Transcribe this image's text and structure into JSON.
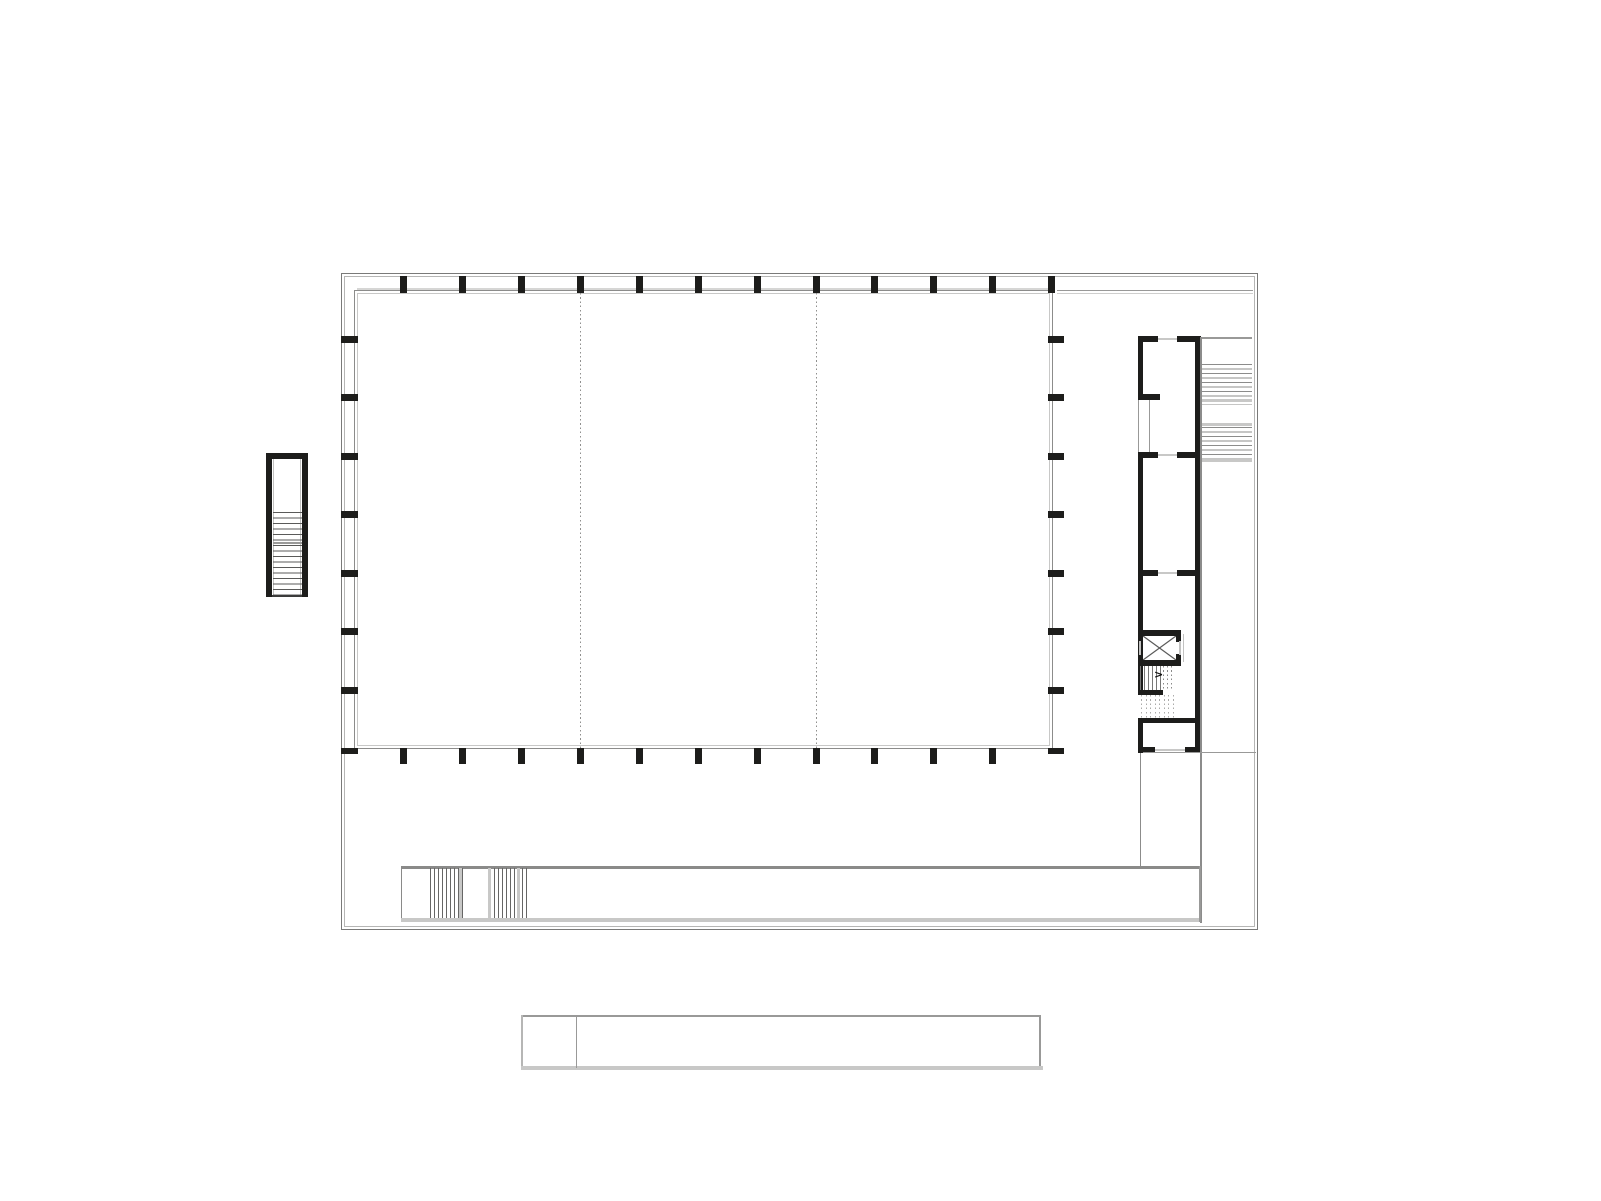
{
  "document": {
    "kind": "architectural-floor-plan",
    "description": "black and white line drawing of a building floor plan: large column-framed hall with three bays, service annex with elevator and stairs on the right, external stair on the left, entry ramp walkway at the bottom, and a detached plan strip below"
  },
  "palette": {
    "wall": "#1d1d1b",
    "line_dark": "#6f6f6e",
    "line_mid": "#999998",
    "line_light": "#c8c8c7",
    "canvas": "#ffffff"
  },
  "canvas": {
    "width": 1601,
    "height": 1201
  },
  "elements": [
    {
      "type": "outline",
      "name": "site-boundary-outer",
      "x": 341,
      "y": 273,
      "w": 917,
      "h": 657,
      "color": "#7a7a79"
    },
    {
      "type": "outline",
      "name": "site-boundary-inner",
      "x": 344,
      "y": 276,
      "w": 911,
      "h": 651,
      "color": "#b6b6b5"
    },
    {
      "type": "bar",
      "name": "canopy-edge-top-line",
      "x": 357,
      "y": 288,
      "w": 696,
      "h": 2,
      "color": "#d6d6d5"
    },
    {
      "type": "outline",
      "name": "hall-outline",
      "x": 354,
      "y": 290,
      "w": 699,
      "h": 459,
      "color": "#8c8c8b"
    },
    {
      "type": "outline",
      "name": "hall-inner-face-line",
      "x": 357,
      "y": 293,
      "w": 693,
      "h": 453,
      "color": "#c8c8c7"
    },
    {
      "type": "vdotted",
      "name": "hall-bay-divider-line-1",
      "x": 580,
      "h": 455,
      "y": 293,
      "color": "#8f8f8e"
    },
    {
      "type": "vdotted",
      "name": "hall-bay-divider-line-2",
      "x": 816,
      "h": 455,
      "y": 293,
      "color": "#8f8f8e"
    },
    {
      "type": "bar",
      "name": "hall-top-line-extension",
      "x": 1057,
      "y": 290,
      "w": 196,
      "h": 1,
      "color": "#999998"
    },
    {
      "type": "bar",
      "name": "hall-top-line-extension-light",
      "x": 1057,
      "y": 293,
      "w": 196,
      "h": 1,
      "color": "#cfcfce"
    },
    {
      "type": "repeat",
      "name": "hall-columns-top",
      "xs": [
        400,
        459,
        518,
        577,
        636,
        695,
        754,
        813,
        871,
        930,
        989,
        1048
      ],
      "y": 276,
      "w": 7,
      "h": 17,
      "color": "#1d1d1b"
    },
    {
      "type": "repeat",
      "name": "hall-columns-bottom",
      "xs": [
        400,
        459,
        518,
        577,
        636,
        695,
        754,
        813,
        871,
        930,
        989
      ],
      "y": 748,
      "w": 7,
      "h": 16,
      "color": "#1d1d1b"
    },
    {
      "type": "repeat",
      "name": "hall-columns-left",
      "ys": [
        336,
        394,
        453,
        511,
        570,
        628,
        687
      ],
      "x": 341,
      "w": 17,
      "h": 7,
      "color": "#1d1d1b"
    },
    {
      "type": "repeat",
      "name": "hall-columns-right",
      "ys": [
        336,
        394,
        453,
        511,
        570,
        628,
        687
      ],
      "x": 1048,
      "w": 16,
      "h": 7,
      "color": "#1d1d1b"
    },
    {
      "type": "bar",
      "name": "hall-corner-column-bottom-left",
      "x": 341,
      "y": 748,
      "w": 17,
      "h": 6,
      "color": "#1d1d1b"
    },
    {
      "type": "bar",
      "name": "hall-corner-column-bottom-right",
      "x": 1048,
      "y": 748,
      "w": 16,
      "h": 6,
      "color": "#1d1d1b"
    },
    {
      "type": "bar",
      "name": "left-stair-wall-left",
      "x": 266,
      "y": 453,
      "w": 6,
      "h": 144,
      "color": "#1d1d1b"
    },
    {
      "type": "bar",
      "name": "left-stair-wall-top",
      "x": 266,
      "y": 453,
      "w": 42,
      "h": 6,
      "color": "#1d1d1b"
    },
    {
      "type": "bar",
      "name": "left-stair-wall-right",
      "x": 302,
      "y": 453,
      "w": 6,
      "h": 144,
      "color": "#1d1d1b"
    },
    {
      "type": "bar",
      "name": "left-stair-bottom-line",
      "x": 272,
      "y": 595,
      "w": 30,
      "h": 2,
      "color": "#3c3c3b"
    },
    {
      "type": "bar",
      "name": "left-stair-inner-face-left",
      "x": 273,
      "y": 459,
      "w": 1,
      "h": 136,
      "color": "#c2c2c1"
    },
    {
      "type": "bar",
      "name": "left-stair-inner-face-right",
      "x": 300,
      "y": 459,
      "w": 1,
      "h": 136,
      "color": "#c2c2c1"
    },
    {
      "type": "hlines",
      "name": "left-stair-treads",
      "x": 273,
      "y": 512,
      "w": 29,
      "count": 15,
      "gap": 5.5,
      "color": "#5a5a59"
    },
    {
      "type": "bar",
      "name": "left-stair-landing-line",
      "x": 273,
      "y": 542,
      "w": 29,
      "h": 2,
      "color": "#9a9a99"
    },
    {
      "type": "bar",
      "name": "annex-wall-left-upper",
      "x": 1138,
      "y": 336,
      "w": 5,
      "h": 64,
      "color": "#1d1d1b"
    },
    {
      "type": "bar",
      "name": "annex-glazing-line-outer",
      "x": 1138,
      "y": 400,
      "w": 1,
      "h": 53,
      "color": "#999998"
    },
    {
      "type": "bar",
      "name": "annex-glazing-line-inner",
      "x": 1149,
      "y": 400,
      "w": 1,
      "h": 53,
      "color": "#999998"
    },
    {
      "type": "bar",
      "name": "annex-wall-left-mid",
      "x": 1138,
      "y": 453,
      "w": 5,
      "h": 242,
      "color": "#1d1d1b"
    },
    {
      "type": "bar",
      "name": "annex-wall-left-lower",
      "x": 1138,
      "y": 718,
      "w": 5,
      "h": 35,
      "color": "#1d1d1b"
    },
    {
      "type": "bar",
      "name": "annex-wall-right",
      "x": 1195,
      "y": 336,
      "w": 6,
      "h": 417,
      "color": "#1d1d1b"
    },
    {
      "type": "bar",
      "name": "annex-wall-top-a",
      "x": 1138,
      "y": 336,
      "w": 20,
      "h": 6,
      "color": "#1d1d1b"
    },
    {
      "type": "bar",
      "name": "annex-wall-top-b",
      "x": 1177,
      "y": 336,
      "w": 24,
      "h": 6,
      "color": "#1d1d1b"
    },
    {
      "type": "bar",
      "name": "annex-door-top",
      "x": 1158,
      "y": 338,
      "w": 19,
      "h": 2,
      "color": "#c8c8c7"
    },
    {
      "type": "bar",
      "name": "annex-wall-bottom-a",
      "x": 1138,
      "y": 747,
      "w": 17,
      "h": 6,
      "color": "#1d1d1b"
    },
    {
      "type": "bar",
      "name": "annex-wall-bottom-b",
      "x": 1185,
      "y": 747,
      "w": 16,
      "h": 6,
      "color": "#1d1d1b"
    },
    {
      "type": "bar",
      "name": "annex-door-bottom",
      "x": 1155,
      "y": 749,
      "w": 30,
      "h": 2,
      "color": "#c8c8c7"
    },
    {
      "type": "bar",
      "name": "annex-partition-wall-a",
      "x": 1138,
      "y": 394,
      "w": 22,
      "h": 6,
      "color": "#1d1d1b"
    },
    {
      "type": "bar",
      "name": "annex-partition-wall-b1",
      "x": 1138,
      "y": 452,
      "w": 20,
      "h": 6,
      "color": "#1d1d1b"
    },
    {
      "type": "bar",
      "name": "annex-partition-wall-b2",
      "x": 1177,
      "y": 452,
      "w": 24,
      "h": 6,
      "color": "#1d1d1b"
    },
    {
      "type": "bar",
      "name": "annex-door-b",
      "x": 1158,
      "y": 454,
      "w": 19,
      "h": 2,
      "color": "#c8c8c7"
    },
    {
      "type": "bar",
      "name": "annex-partition-wall-c1",
      "x": 1138,
      "y": 570,
      "w": 20,
      "h": 6,
      "color": "#1d1d1b"
    },
    {
      "type": "bar",
      "name": "annex-partition-wall-c2",
      "x": 1177,
      "y": 570,
      "w": 24,
      "h": 6,
      "color": "#1d1d1b"
    },
    {
      "type": "bar",
      "name": "annex-door-c",
      "x": 1158,
      "y": 572,
      "w": 19,
      "h": 2,
      "color": "#c8c8c7"
    },
    {
      "type": "bar",
      "name": "elevator-wall-top",
      "x": 1138,
      "y": 630,
      "w": 43,
      "h": 6,
      "color": "#1d1d1b"
    },
    {
      "type": "bar",
      "name": "elevator-wall-bottom",
      "x": 1138,
      "y": 660,
      "w": 43,
      "h": 6,
      "color": "#1d1d1b"
    },
    {
      "type": "bar",
      "name": "elevator-wall-left-a",
      "x": 1138,
      "y": 630,
      "w": 5,
      "h": 12,
      "color": "#1d1d1b"
    },
    {
      "type": "bar",
      "name": "elevator-wall-left-b",
      "x": 1138,
      "y": 654,
      "w": 5,
      "h": 12,
      "color": "#1d1d1b"
    },
    {
      "type": "bar",
      "name": "elevator-door-left",
      "x": 1139,
      "y": 641,
      "w": 2,
      "h": 14,
      "color": "#c2c2c1"
    },
    {
      "type": "bar",
      "name": "elevator-wall-right-a",
      "x": 1176,
      "y": 630,
      "w": 5,
      "h": 12,
      "color": "#1d1d1b"
    },
    {
      "type": "bar",
      "name": "elevator-wall-right-b",
      "x": 1176,
      "y": 654,
      "w": 5,
      "h": 12,
      "color": "#1d1d1b"
    },
    {
      "type": "bar",
      "name": "elevator-door-right",
      "x": 1179,
      "y": 641,
      "w": 2,
      "h": 14,
      "color": "#c2c2c1"
    },
    {
      "type": "cross",
      "name": "elevator-cross-symbol",
      "x": 1143,
      "y": 636,
      "w": 33,
      "h": 24,
      "color": "#5a5a59"
    },
    {
      "type": "bar",
      "name": "elevator-shaft-side-line",
      "x": 1183,
      "y": 634,
      "w": 1,
      "h": 28,
      "color": "#c2c2c1"
    },
    {
      "type": "vlines",
      "name": "annex-stair-treads-solid",
      "x": 1140,
      "y": 666,
      "h": 24,
      "count": 6,
      "gap": 4,
      "color": "#787877"
    },
    {
      "type": "vdotted",
      "name": "annex-stair-treads-dashed-upper",
      "x": 1163,
      "xs": [
        1163,
        1167,
        1171
      ],
      "y": 666,
      "h": 24,
      "color": "#8a8a89"
    },
    {
      "type": "glyph",
      "name": "annex-stair-direction-arrow",
      "x": 1154,
      "y": 669,
      "text": ">",
      "size": 11,
      "color": "#111111"
    },
    {
      "type": "bar",
      "name": "annex-stair-mid-wall",
      "x": 1138,
      "y": 690,
      "w": 25,
      "h": 5,
      "color": "#1d1d1b"
    },
    {
      "type": "vdotted",
      "name": "annex-stair-treads-dashed-lower",
      "x": 1141,
      "xs": [
        1141,
        1145.5,
        1150,
        1154.5,
        1159,
        1163.5,
        1168,
        1172.5
      ],
      "y": 695,
      "h": 23,
      "color": "#ababaa"
    },
    {
      "type": "bar",
      "name": "annex-stair-bottom-wall",
      "x": 1138,
      "y": 718,
      "w": 63,
      "h": 5,
      "color": "#1d1d1b"
    },
    {
      "type": "bar",
      "name": "right-stair-top-line",
      "x": 1201,
      "y": 337,
      "w": 51,
      "h": 2,
      "color": "#999998"
    },
    {
      "type": "hlines",
      "name": "right-stair-treads-upper",
      "x": 1201,
      "y": 364,
      "w": 51,
      "count": 9,
      "gap": 4.5,
      "color": "#8c8c8b"
    },
    {
      "type": "bar",
      "name": "right-stair-landing-line-1",
      "x": 1201,
      "y": 399,
      "w": 51,
      "h": 3,
      "color": "#c8c8c7"
    },
    {
      "type": "bar",
      "name": "right-stair-landing-line-2",
      "x": 1201,
      "y": 423,
      "w": 51,
      "h": 3,
      "color": "#c8c8c7"
    },
    {
      "type": "hlines",
      "name": "right-stair-treads-lower",
      "x": 1201,
      "y": 427,
      "w": 51,
      "count": 8,
      "gap": 4.5,
      "color": "#8c8c8b"
    },
    {
      "type": "bar",
      "name": "right-stair-landing-line-3",
      "x": 1201,
      "y": 459,
      "w": 51,
      "h": 3,
      "color": "#c8c8c7"
    },
    {
      "type": "bar",
      "name": "right-gallery-edge-line",
      "x": 1200,
      "y": 337,
      "w": 2,
      "h": 586,
      "color": "#8c8c8b"
    },
    {
      "type": "bar",
      "name": "annex-walkway-connector-vline",
      "x": 1140,
      "y": 753,
      "w": 1,
      "h": 114,
      "color": "#8c8c8b"
    },
    {
      "type": "bar",
      "name": "annex-walkway-connector-hline",
      "x": 1143,
      "y": 752,
      "w": 113,
      "h": 1,
      "color": "#999998"
    },
    {
      "type": "bar",
      "name": "walkway-top-edge",
      "x": 401,
      "y": 866,
      "w": 799,
      "h": 3,
      "color": "#8a8a89"
    },
    {
      "type": "bar",
      "name": "walkway-left-edge",
      "x": 401,
      "y": 866,
      "w": 1,
      "h": 56,
      "color": "#8a8a89"
    },
    {
      "type": "bar",
      "name": "walkway-bottom-edge",
      "x": 401,
      "y": 918,
      "w": 800,
      "h": 4,
      "color": "#c8c8c7"
    },
    {
      "type": "bar",
      "name": "walkway-right-edge",
      "x": 1199,
      "y": 866,
      "w": 2,
      "h": 56,
      "color": "#999998"
    },
    {
      "type": "vlines",
      "name": "ramp-hatch-group-a",
      "x": 430,
      "y": 868,
      "h": 50,
      "count": 9,
      "gap": 4,
      "color": "#666665"
    },
    {
      "type": "bar",
      "name": "ramp-hatch-a-light-band",
      "x": 459,
      "y": 868,
      "w": 3,
      "h": 50,
      "color": "#c8c8c7"
    },
    {
      "type": "bar",
      "name": "ramp-hatch-b-light-band-1",
      "x": 488,
      "y": 868,
      "w": 3,
      "h": 50,
      "color": "#c8c8c7"
    },
    {
      "type": "vlines",
      "name": "ramp-hatch-group-b",
      "x": 494,
      "y": 868,
      "h": 50,
      "count": 6,
      "gap": 4,
      "color": "#666665"
    },
    {
      "type": "bar",
      "name": "ramp-hatch-b-light-band-2",
      "x": 517,
      "y": 868,
      "w": 3,
      "h": 50,
      "color": "#c8c8c7"
    },
    {
      "type": "vlines",
      "name": "ramp-hatch-group-b-tail",
      "x": 522,
      "y": 868,
      "h": 50,
      "count": 2,
      "gap": 4,
      "color": "#666665"
    },
    {
      "type": "bar",
      "name": "plan-strip-top-edge",
      "x": 521,
      "y": 1015,
      "w": 520,
      "h": 2,
      "color": "#999998"
    },
    {
      "type": "bar",
      "name": "plan-strip-right-edge",
      "x": 1039,
      "y": 1015,
      "w": 2,
      "h": 55,
      "color": "#999998"
    },
    {
      "type": "bar",
      "name": "plan-strip-left-edge",
      "x": 521,
      "y": 1015,
      "w": 2,
      "h": 53,
      "color": "#b6b6b5"
    },
    {
      "type": "bar",
      "name": "plan-strip-bottom-edge",
      "x": 521,
      "y": 1066,
      "w": 522,
      "h": 4,
      "color": "#c8c8c7"
    },
    {
      "type": "bar",
      "name": "plan-strip-divider-line",
      "x": 576,
      "y": 1015,
      "w": 1,
      "h": 53,
      "color": "#999998"
    }
  ]
}
